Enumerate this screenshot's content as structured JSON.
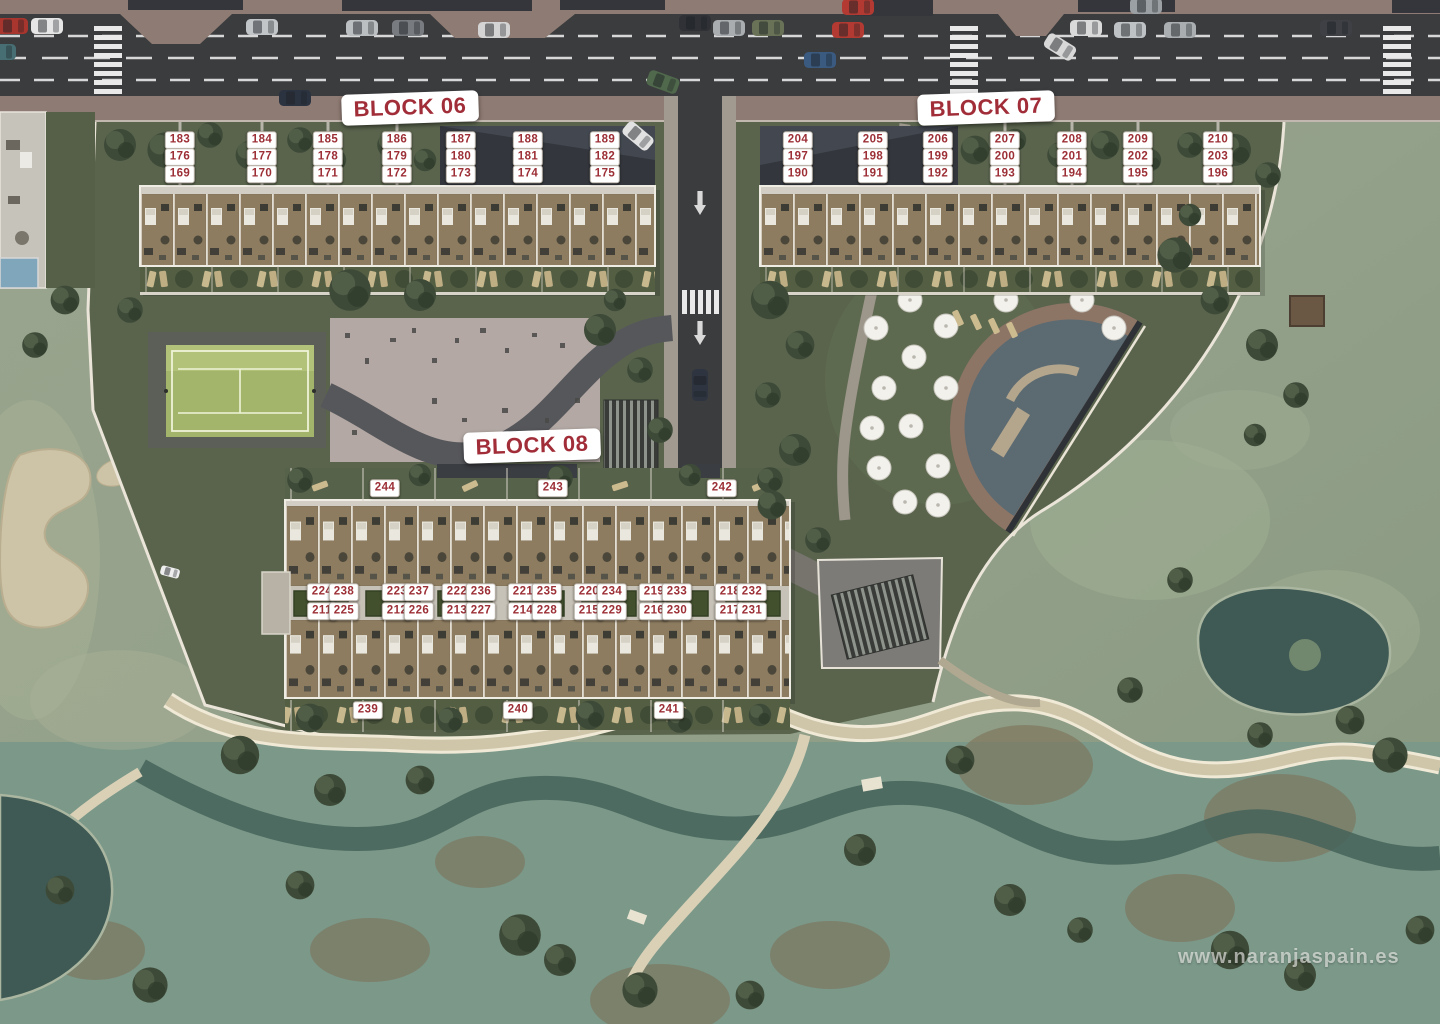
{
  "map": {
    "watermark": "www.naranjaspain.es",
    "colors": {
      "unit_number_text": "#9c2f36",
      "unit_badge_background": "#ffffff",
      "block_label_text": "#a12d38",
      "road_asphalt": "#3b3c3e",
      "development_grass": "#5a644d",
      "golf_grass": "#96a28c",
      "pool_water": "#5c6a72"
    },
    "blocks": [
      {
        "id": "block-06",
        "label": "BLOCK 06",
        "label_x": 410,
        "label_y": 108,
        "badges": [
          {
            "n": "183",
            "x": 180,
            "y": 140
          },
          {
            "n": "184",
            "x": 262,
            "y": 140
          },
          {
            "n": "185",
            "x": 328,
            "y": 140
          },
          {
            "n": "186",
            "x": 397,
            "y": 140
          },
          {
            "n": "187",
            "x": 461,
            "y": 140
          },
          {
            "n": "188",
            "x": 528,
            "y": 140
          },
          {
            "n": "189",
            "x": 605,
            "y": 140
          },
          {
            "n": "176",
            "x": 180,
            "y": 157
          },
          {
            "n": "177",
            "x": 262,
            "y": 157
          },
          {
            "n": "178",
            "x": 328,
            "y": 157
          },
          {
            "n": "179",
            "x": 397,
            "y": 157
          },
          {
            "n": "180",
            "x": 461,
            "y": 157
          },
          {
            "n": "181",
            "x": 528,
            "y": 157
          },
          {
            "n": "182",
            "x": 605,
            "y": 157
          },
          {
            "n": "169",
            "x": 180,
            "y": 174
          },
          {
            "n": "170",
            "x": 262,
            "y": 174
          },
          {
            "n": "171",
            "x": 328,
            "y": 174
          },
          {
            "n": "172",
            "x": 397,
            "y": 174
          },
          {
            "n": "173",
            "x": 461,
            "y": 174
          },
          {
            "n": "174",
            "x": 528,
            "y": 174
          },
          {
            "n": "175",
            "x": 605,
            "y": 174
          }
        ]
      },
      {
        "id": "block-07",
        "label": "BLOCK 07",
        "label_x": 986,
        "label_y": 108,
        "badges": [
          {
            "n": "204",
            "x": 798,
            "y": 140
          },
          {
            "n": "205",
            "x": 873,
            "y": 140
          },
          {
            "n": "206",
            "x": 938,
            "y": 140
          },
          {
            "n": "207",
            "x": 1005,
            "y": 140
          },
          {
            "n": "208",
            "x": 1072,
            "y": 140
          },
          {
            "n": "209",
            "x": 1138,
            "y": 140
          },
          {
            "n": "210",
            "x": 1218,
            "y": 140
          },
          {
            "n": "197",
            "x": 798,
            "y": 157
          },
          {
            "n": "198",
            "x": 873,
            "y": 157
          },
          {
            "n": "199",
            "x": 938,
            "y": 157
          },
          {
            "n": "200",
            "x": 1005,
            "y": 157
          },
          {
            "n": "201",
            "x": 1072,
            "y": 157
          },
          {
            "n": "202",
            "x": 1138,
            "y": 157
          },
          {
            "n": "203",
            "x": 1218,
            "y": 157
          },
          {
            "n": "190",
            "x": 798,
            "y": 174
          },
          {
            "n": "191",
            "x": 873,
            "y": 174
          },
          {
            "n": "192",
            "x": 938,
            "y": 174
          },
          {
            "n": "193",
            "x": 1005,
            "y": 174
          },
          {
            "n": "194",
            "x": 1072,
            "y": 174
          },
          {
            "n": "195",
            "x": 1138,
            "y": 174
          },
          {
            "n": "196",
            "x": 1218,
            "y": 174
          }
        ]
      },
      {
        "id": "block-08",
        "label": "BLOCK 08",
        "label_x": 532,
        "label_y": 446,
        "badges": [
          {
            "n": "244",
            "x": 385,
            "y": 488
          },
          {
            "n": "243",
            "x": 553,
            "y": 488
          },
          {
            "n": "242",
            "x": 722,
            "y": 488
          },
          {
            "n": "224",
            "x": 322,
            "y": 592
          },
          {
            "n": "238",
            "x": 344,
            "y": 592
          },
          {
            "n": "223",
            "x": 397,
            "y": 592
          },
          {
            "n": "237",
            "x": 419,
            "y": 592
          },
          {
            "n": "222",
            "x": 457,
            "y": 592
          },
          {
            "n": "236",
            "x": 481,
            "y": 592
          },
          {
            "n": "221",
            "x": 523,
            "y": 592
          },
          {
            "n": "235",
            "x": 547,
            "y": 592
          },
          {
            "n": "220",
            "x": 589,
            "y": 592
          },
          {
            "n": "234",
            "x": 612,
            "y": 592
          },
          {
            "n": "219",
            "x": 654,
            "y": 592
          },
          {
            "n": "233",
            "x": 677,
            "y": 592
          },
          {
            "n": "218",
            "x": 730,
            "y": 592
          },
          {
            "n": "232",
            "x": 752,
            "y": 592
          },
          {
            "n": "211",
            "x": 322,
            "y": 611
          },
          {
            "n": "225",
            "x": 344,
            "y": 611
          },
          {
            "n": "212",
            "x": 397,
            "y": 611
          },
          {
            "n": "226",
            "x": 419,
            "y": 611
          },
          {
            "n": "213",
            "x": 457,
            "y": 611
          },
          {
            "n": "227",
            "x": 481,
            "y": 611
          },
          {
            "n": "214",
            "x": 523,
            "y": 611
          },
          {
            "n": "228",
            "x": 547,
            "y": 611
          },
          {
            "n": "215",
            "x": 589,
            "y": 611
          },
          {
            "n": "229",
            "x": 612,
            "y": 611
          },
          {
            "n": "216",
            "x": 654,
            "y": 611
          },
          {
            "n": "230",
            "x": 677,
            "y": 611
          },
          {
            "n": "217",
            "x": 730,
            "y": 611
          },
          {
            "n": "231",
            "x": 752,
            "y": 611
          },
          {
            "n": "239",
            "x": 368,
            "y": 710
          },
          {
            "n": "240",
            "x": 518,
            "y": 710
          },
          {
            "n": "241",
            "x": 669,
            "y": 710
          }
        ]
      }
    ]
  }
}
